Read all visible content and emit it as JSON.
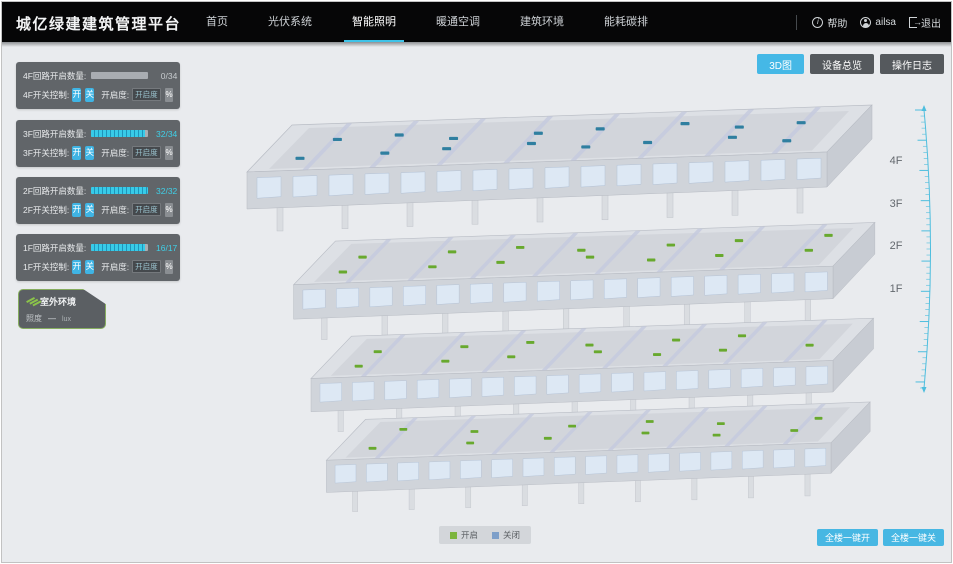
{
  "header": {
    "title": "城亿绿建建筑管理平台",
    "nav": [
      {
        "label": "首页"
      },
      {
        "label": "光伏系统"
      },
      {
        "label": "智能照明",
        "active": true
      },
      {
        "label": "暖通空调"
      },
      {
        "label": "建筑环境"
      },
      {
        "label": "能耗碳排"
      }
    ],
    "help": "帮助",
    "username": "ailsa",
    "logout": "退出"
  },
  "toolbar": {
    "view_3d": "3D图",
    "device_overview": "设备总览",
    "operation_log": "操作日志"
  },
  "floor_panels": [
    {
      "circuit_label": "4F回路开启数量:",
      "count": "0/34",
      "progress": 0,
      "switch_label": "4F开关控制:",
      "on_label": "开",
      "off_label": "关",
      "openness_label": "开启度:",
      "openness_placeholder": "开启度",
      "percent_label": "%"
    },
    {
      "circuit_label": "3F回路开启数量:",
      "count": "32/34",
      "progress": 94,
      "switch_label": "3F开关控制:",
      "on_label": "开",
      "off_label": "关",
      "openness_label": "开启度:",
      "openness_placeholder": "开启度",
      "percent_label": "%"
    },
    {
      "circuit_label": "2F回路开启数量:",
      "count": "32/32",
      "progress": 100,
      "switch_label": "2F开关控制:",
      "on_label": "开",
      "off_label": "关",
      "openness_label": "开启度:",
      "openness_placeholder": "开启度",
      "percent_label": "%"
    },
    {
      "circuit_label": "1F回路开启数量:",
      "count": "16/17",
      "progress": 94,
      "switch_label": "1F开关控制:",
      "on_label": "开",
      "off_label": "关",
      "openness_label": "开启度:",
      "openness_placeholder": "开启度",
      "percent_label": "%"
    }
  ],
  "outdoor": {
    "title": "室外环境",
    "illuminance_label": "照度",
    "illuminance_value": "—",
    "illuminance_unit": "lux"
  },
  "building": {
    "floor_labels": [
      "4F",
      "3F",
      "2F",
      "1F"
    ],
    "floors": [
      {
        "label": "4F",
        "marker_color": "#2f7fa0",
        "marker_count": 16
      },
      {
        "label": "3F",
        "marker_color": "#68a92e",
        "marker_count": 14
      },
      {
        "label": "2F",
        "marker_color": "#68a92e",
        "marker_count": 13
      },
      {
        "label": "1F",
        "marker_color": "#68a92e",
        "marker_count": 12
      }
    ]
  },
  "legend": {
    "on_label": "开启",
    "on_color": "#7cb53e",
    "off_label": "关闭",
    "off_color": "#7d9fc9"
  },
  "bottom_actions": {
    "all_on": "全楼一键开",
    "all_off": "全楼一键关"
  },
  "icons": {
    "help": "circle-info-icon",
    "user": "circle-user-icon",
    "logout": "exit-arrow-icon",
    "outdoor": "rays-icon",
    "legend_on": "square-swatch",
    "legend_off": "square-swatch"
  },
  "colors": {
    "accent": "#45b8e6",
    "nav_underline": "#3fc3e8",
    "scale": "#4ebede",
    "background": "#e9ebee"
  }
}
